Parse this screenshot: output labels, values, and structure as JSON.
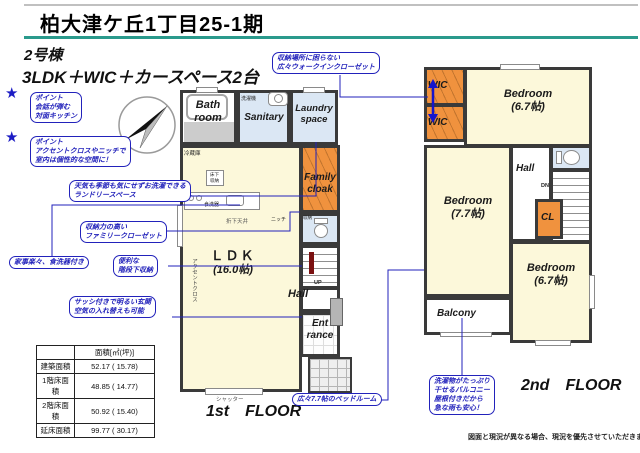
{
  "header": {
    "title": "柏大津ケ丘1丁目25-1期",
    "building_no": "2号棟",
    "plan_type": "3LDK＋WIC＋カースペース2台"
  },
  "icons": {
    "star": "★"
  },
  "callouts": {
    "wic": {
      "lines": [
        "収納場所に困らない",
        "広々ウォークインクローゼット"
      ]
    },
    "point_kitchen": {
      "lines": [
        "ポイント",
        "会話が弾む",
        "対面キッチン"
      ]
    },
    "point_accent": {
      "lines": [
        "ポイント",
        "アクセントクロスやニッチで",
        "室内は個性的な空間に！"
      ]
    },
    "laundry": {
      "lines": [
        "天気も季節も気にせずお洗濯できる",
        "ランドリースペース"
      ]
    },
    "family_closet": {
      "lines": [
        "収納力の高い",
        "ファミリークローゼット"
      ]
    },
    "dishwasher": {
      "lines": [
        "家事楽々、食洗器付き"
      ]
    },
    "under_stairs": {
      "lines": [
        "便利な",
        "階段下収納"
      ]
    },
    "entrance": {
      "lines": [
        "サッシ付きで明るい玄関",
        "空気の入れ替えも可能"
      ]
    },
    "bedroom77": {
      "lines": [
        "広々7.7帖のベッドルーム"
      ]
    },
    "balcony": {
      "lines": [
        "洗濯物がたっぷり",
        "干せるバルコニー",
        "屋根付きだから",
        "急な雨も安心！"
      ]
    }
  },
  "floor1": {
    "label": "1st　FLOOR",
    "rooms": {
      "bath": {
        "line1": "Bath",
        "line2": "room"
      },
      "sanitary": "Sanitary",
      "laundry": {
        "line1": "Laundry",
        "line2": "space"
      },
      "family_cloak": {
        "line1": "Family",
        "line2": "cloak"
      },
      "ldk": {
        "line1": "ＬＤＫ",
        "line2": "(16.0帖)"
      },
      "hall": "Hall",
      "entrance": {
        "line1": "Ent",
        "line2": "rance"
      }
    },
    "small_labels": {
      "washing_machine": "洗濯機",
      "refrigerator": "冷蔵庫",
      "floor_storage_1": "床下",
      "floor_storage_2": "収納",
      "dishwasher": "食洗器",
      "dropped_ceiling": "折下天井",
      "niche": "ニッチ",
      "storage": "収納",
      "up": "UP",
      "accent_cloth": "アクセントクロス",
      "shutter": "シャッター"
    }
  },
  "floor2": {
    "label": "2nd　FLOOR",
    "rooms": {
      "wic1": "WIC",
      "wic2": "WIC",
      "bedroom_67_top": {
        "line1": "Bedroom",
        "line2": "(6.7帖)"
      },
      "bedroom_77": {
        "line1": "Bedroom",
        "line2": "(7.7帖)"
      },
      "bedroom_67_bottom": {
        "line1": "Bedroom",
        "line2": "(6.7帖)"
      },
      "hall": "Hall",
      "cl": "CL",
      "balcony": "Balcony"
    },
    "small_labels": {
      "dn": "DN"
    }
  },
  "area_table": {
    "header": "面積[㎡(坪)]",
    "rows": [
      {
        "label": "建築面積",
        "value": "52.17 ( 15.78)"
      },
      {
        "label": "1階床面積",
        "value": "48.85 ( 14.77)"
      },
      {
        "label": "2階床面積",
        "value": "50.92 ( 15.40)"
      },
      {
        "label": "延床面積",
        "value": "99.77 ( 30.17)"
      }
    ]
  },
  "disclaimer": "図面と現況が異なる場合、現況を優先させていただきます。",
  "colors": {
    "accent_blue": "#2222bb",
    "teal_rule": "#2a9a8c",
    "room_yellow": "#fcf8da",
    "room_blue": "#dbe7f4",
    "room_orange": "#f0923e",
    "wall": "#3a3a3a"
  }
}
